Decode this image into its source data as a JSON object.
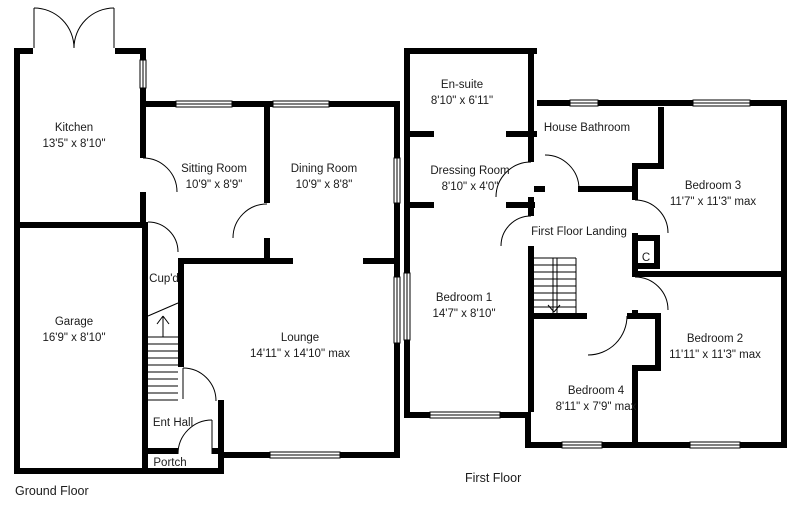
{
  "ground": {
    "label": "Ground Floor",
    "rooms": {
      "kitchen": {
        "name": "Kitchen",
        "dims": "13'5\" x 8'10\""
      },
      "sitting": {
        "name": "Sitting Room",
        "dims": "10'9\" x 8'9\""
      },
      "dining": {
        "name": "Dining Room",
        "dims": "10'9\" x 8'8\""
      },
      "garage": {
        "name": "Garage",
        "dims": "16'9\" x 8'10\""
      },
      "cupboard": {
        "name": "Cup'd"
      },
      "lounge": {
        "name": "Lounge",
        "dims": "14'11\" x 14'10\" max"
      },
      "ent_hall": {
        "name": "Ent Hall"
      },
      "porch": {
        "name": "Portch"
      }
    }
  },
  "first": {
    "label": "First Floor",
    "rooms": {
      "ensuite": {
        "name": "En-suite",
        "dims": "8'10\" x 6'11\""
      },
      "dressing": {
        "name": "Dressing Room",
        "dims": "8'10\" x 4'0\""
      },
      "bathroom": {
        "name": "House Bathroom"
      },
      "bedroom3": {
        "name": "Bedroom 3",
        "dims": "11'7\" x 11'3\" max"
      },
      "landing": {
        "name": "First Floor Landing"
      },
      "cupboard": {
        "name": "C"
      },
      "bedroom1": {
        "name": "Bedroom 1",
        "dims": "14'7\" x 8'10\""
      },
      "bedroom2": {
        "name": "Bedroom 2",
        "dims": "11'11\" x 11'3\" max"
      },
      "bedroom4": {
        "name": "Bedroom 4",
        "dims": "8'11\" x 7'9\" max"
      }
    }
  }
}
